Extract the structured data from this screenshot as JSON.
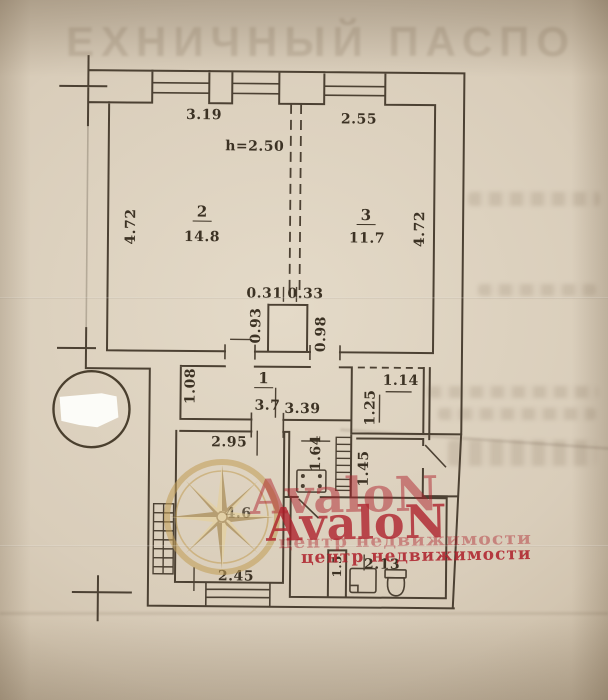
{
  "photo": {
    "ghost_header": "ЕХНИЧНЫЙ ПАСПО"
  },
  "plan": {
    "ceiling_height": "h=2.50",
    "rooms": {
      "room2": {
        "number": "2",
        "area": "14.8",
        "width": "3.19",
        "depth": "4.72"
      },
      "room3": {
        "number": "3",
        "area": "11.7",
        "width": "2.55",
        "depth": "4.72"
      },
      "hall": {
        "number": "1",
        "area": "3.7",
        "width": "3.39"
      },
      "kitchen": {
        "label": "4.6"
      }
    },
    "dims": {
      "d031": "0.31",
      "d033": "0.33",
      "d093": "0.93",
      "d098": "0.98",
      "d108": "1.08",
      "d114": "1.14",
      "d125": "1.25",
      "d164": "1.64",
      "d145": "1.45",
      "d15": "1.5",
      "d213": "2.13",
      "d295": "2.95",
      "d245": "2.45",
      "d472_left": "4.72",
      "d472_right": "4.72"
    }
  },
  "watermark": {
    "brand": "AvaloN",
    "subtitle": "центр недвижимости"
  }
}
